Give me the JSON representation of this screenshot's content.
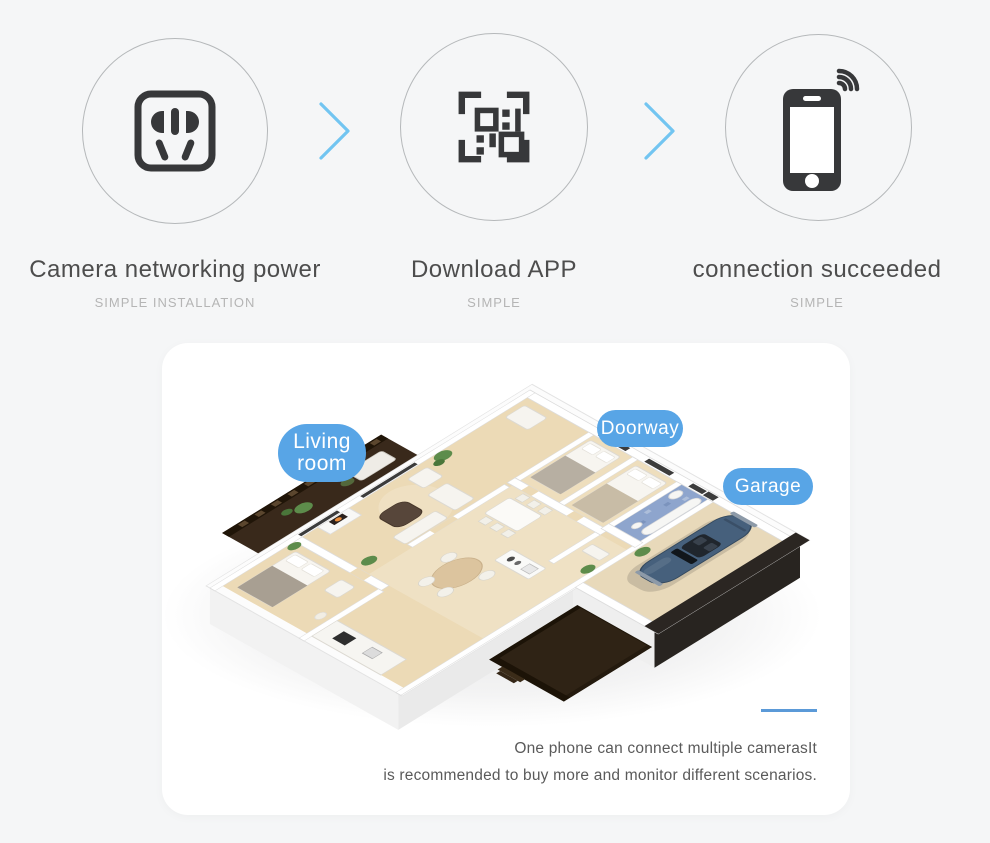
{
  "page": {
    "background_color": "#f5f6f7"
  },
  "steps": {
    "arrow_color": "#72c5f1",
    "circle_border_color": "#b5b8ba",
    "icon_color": "#37383a",
    "items": [
      {
        "title": "Camera networking power",
        "subtitle": "SIMPLE INSTALLATION",
        "icon": "power-socket-icon"
      },
      {
        "title": "Download APP",
        "subtitle": "SIMPLE",
        "icon": "qr-scan-icon"
      },
      {
        "title": "connection succeeded",
        "subtitle": "SIMPLE",
        "icon": "phone-wifi-icon"
      }
    ]
  },
  "floorplan": {
    "badge_color": "#58a5e6",
    "accent_line_color": "#5b9ad8",
    "labels": {
      "living_room": {
        "line1": "Living",
        "line2": "room"
      },
      "doorway": "Doorway",
      "garage": "Garage"
    },
    "caption": {
      "line1": "One phone can connect multiple camerasIt",
      "line2": "is recommended to buy more and monitor different scenarios."
    }
  }
}
